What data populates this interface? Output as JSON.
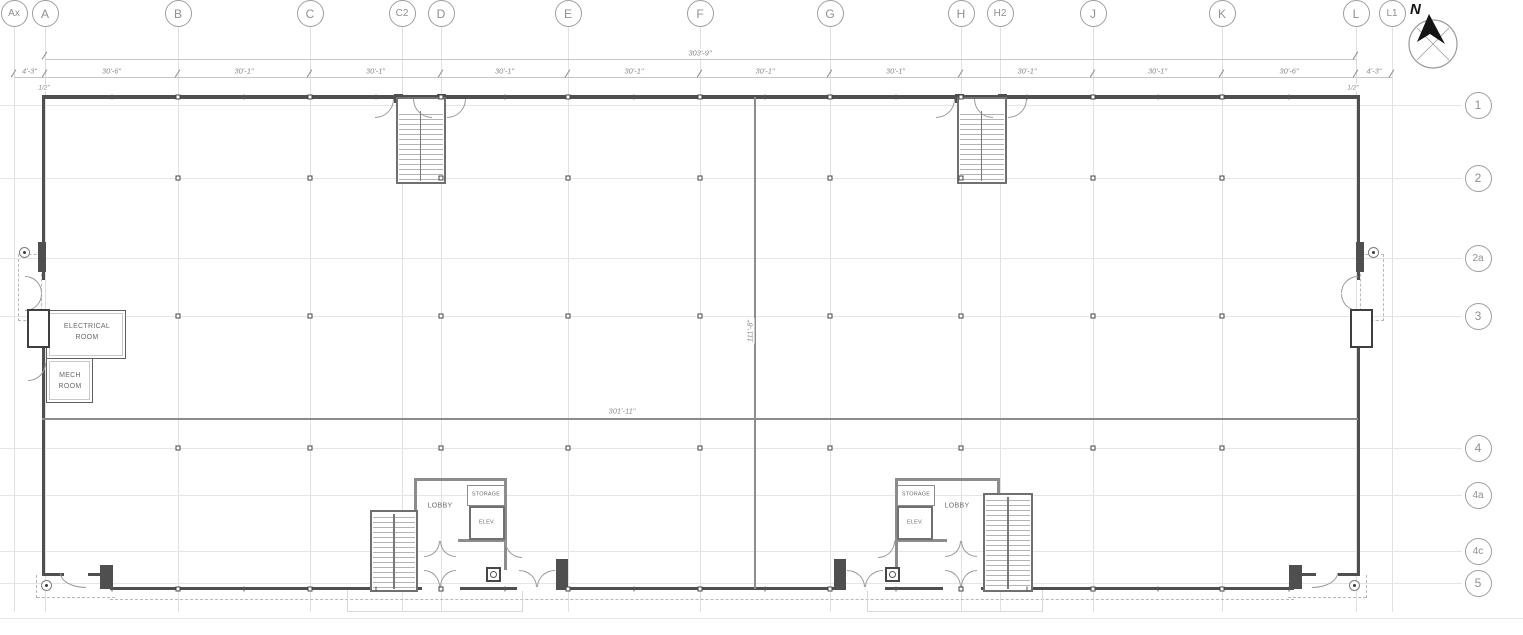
{
  "colors": {
    "wall_dark": "#4f4f4f",
    "wall_medium": "#8c8c8c",
    "grid_line": "#e1e1e1",
    "dim_text": "#8a8a8a",
    "bubble_stroke": "#9e9e9e",
    "north_arrow": "#141414"
  },
  "grid": {
    "columns": [
      {
        "label": "Ax",
        "x": 14
      },
      {
        "label": "A",
        "x": 45
      },
      {
        "label": "B",
        "x": 178
      },
      {
        "label": "C",
        "x": 310
      },
      {
        "label": "C2",
        "x": 402
      },
      {
        "label": "D",
        "x": 441
      },
      {
        "label": "E",
        "x": 568
      },
      {
        "label": "F",
        "x": 700
      },
      {
        "label": "G",
        "x": 830
      },
      {
        "label": "H",
        "x": 961
      },
      {
        "label": "H2",
        "x": 1000
      },
      {
        "label": "J",
        "x": 1093
      },
      {
        "label": "K",
        "x": 1222
      },
      {
        "label": "L",
        "x": 1356
      },
      {
        "label": "L1",
        "x": 1392
      }
    ],
    "rows": [
      {
        "label": "1",
        "y": 105
      },
      {
        "label": "2",
        "y": 178
      },
      {
        "label": "2a",
        "y": 258
      },
      {
        "label": "3",
        "y": 316
      },
      {
        "label": "4",
        "y": 448
      },
      {
        "label": "4a",
        "y": 495
      },
      {
        "label": "4c",
        "y": 551
      },
      {
        "label": "5",
        "y": 583
      }
    ],
    "row_bubble_x": 1478,
    "main_columns": [
      "Ax",
      "A",
      "B",
      "C",
      "D",
      "E",
      "F",
      "G",
      "H",
      "J",
      "K",
      "L",
      "L1"
    ],
    "interior_column_letters": [
      "B",
      "C",
      "D",
      "E",
      "F",
      "G",
      "H",
      "J",
      "K"
    ],
    "interior_column_rows": [
      "2",
      "3",
      "4"
    ]
  },
  "dimensions": {
    "overall_top": "303'-9\"",
    "segments": [
      {
        "from": "Ax",
        "to": "A",
        "label": "4'-3\""
      },
      {
        "from": "A",
        "to": "B",
        "label": "30'-6\""
      },
      {
        "from": "B",
        "to": "C",
        "label": "30'-1\""
      },
      {
        "from": "C",
        "to": "D",
        "label": "30'-1\""
      },
      {
        "from": "D",
        "to": "E",
        "label": "30'-1\""
      },
      {
        "from": "E",
        "to": "F",
        "label": "30'-1\""
      },
      {
        "from": "F",
        "to": "G",
        "label": "30'-1\""
      },
      {
        "from": "G",
        "to": "H",
        "label": "30'-1\""
      },
      {
        "from": "H",
        "to": "J",
        "label": "30'-1\""
      },
      {
        "from": "J",
        "to": "K",
        "label": "30'-1\""
      },
      {
        "from": "K",
        "to": "L",
        "label": "30'-6\""
      },
      {
        "from": "L",
        "to": "L1",
        "label": "4'-3\""
      }
    ],
    "left_end": "1/2\"",
    "right_end": "1/2\"",
    "interior_width": "301'-11\"",
    "interior_height": "111'-8\""
  },
  "rooms": {
    "electrical": "ELECTRICAL\nROOM",
    "mech": "MECH\nROOM",
    "lobby_left": "LOBBY",
    "lobby_right": "LOBBY",
    "storage_left": "STORAGE",
    "storage_right": "STORAGE",
    "elev_left": "ELEV.",
    "elev_right": "ELEV."
  },
  "compass": {
    "north_label": "N"
  }
}
